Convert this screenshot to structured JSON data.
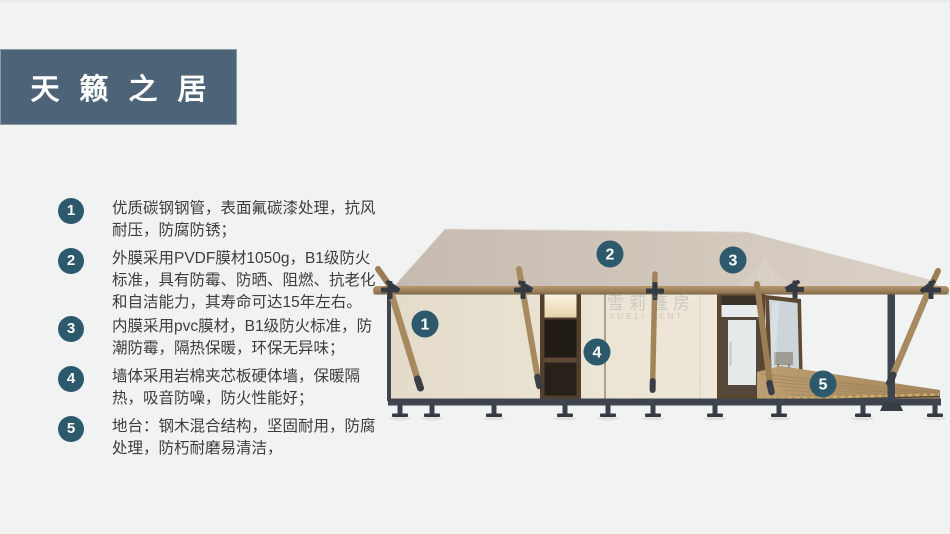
{
  "header": {
    "title": "天籁之居"
  },
  "features": [
    {
      "number": "1",
      "text": "优质碳钢钢管，表面氟碳漆处理，抗风耐压，防腐防锈；"
    },
    {
      "number": "2",
      "text": "外膜采用PVDF膜材1050g，B1级防火标准，具有防霉、防晒、阻燃、抗老化和自洁能力，其寿命可达15年左右。"
    },
    {
      "number": "3",
      "text": "内膜采用pvc膜材，B1级防火标准，防潮防霉，隔热保暖，环保无异味；"
    },
    {
      "number": "4",
      "text": "墙体采用岩棉夹芯板硬体墙，保暖隔热，吸音防噪，防火性能好；"
    },
    {
      "number": "5",
      "text": "地台：钢木混合结构，坚固耐用，防腐处理，防朽耐磨易清洁，"
    }
  ],
  "render": {
    "callouts": [
      {
        "number": "1"
      },
      {
        "number": "2"
      },
      {
        "number": "3"
      },
      {
        "number": "4"
      },
      {
        "number": "5"
      }
    ],
    "watermark": {
      "cn": "雪莉篷房",
      "en": "XUELI TENT"
    }
  },
  "palette": {
    "background": "#f1f2f2",
    "banner": "#4d6478",
    "badge": "#2d596d",
    "roof": "#d0c5b9",
    "wall": "#e9e0d1",
    "wood": "#a5875e",
    "metal": "#3f454e",
    "deck": "#b3946a"
  }
}
